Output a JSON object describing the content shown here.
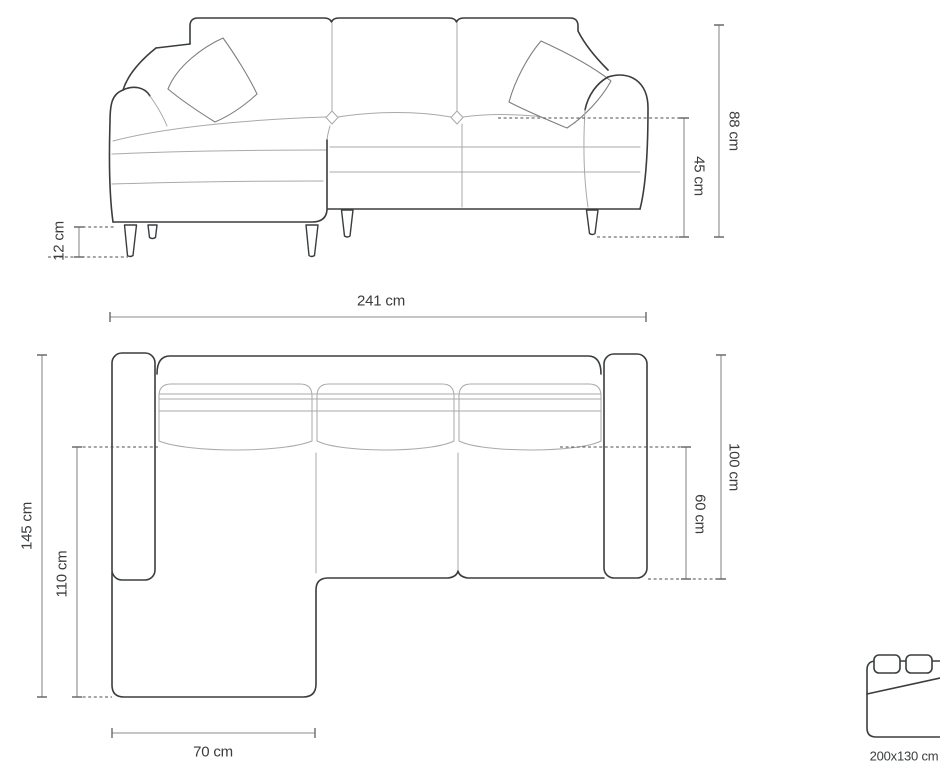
{
  "colors": {
    "outline_dark": "#3a3d3f",
    "line_light": "#a9a9a9",
    "line_medium": "#7e7e7e",
    "dimension_line": "#8b8b8b",
    "dashed_line": "#4f4f4f",
    "text": "#3a3d3f",
    "background": "#ffffff"
  },
  "front_view": {
    "name": "corner sofa front elevation",
    "dimensions": {
      "total_height": "88 cm",
      "seat_height": "45 cm",
      "leg_height": "12 cm"
    }
  },
  "top_view": {
    "name": "corner sofa plan view",
    "dimensions": {
      "total_width": "241 cm",
      "total_depth": "145 cm",
      "chaise_length": "110 cm",
      "chaise_width": "70 cm",
      "body_depth": "100 cm",
      "seat_depth": "60 cm"
    }
  },
  "sofa_bed": {
    "icon": "bed-icon",
    "sleeping_area": "200x130 cm"
  }
}
